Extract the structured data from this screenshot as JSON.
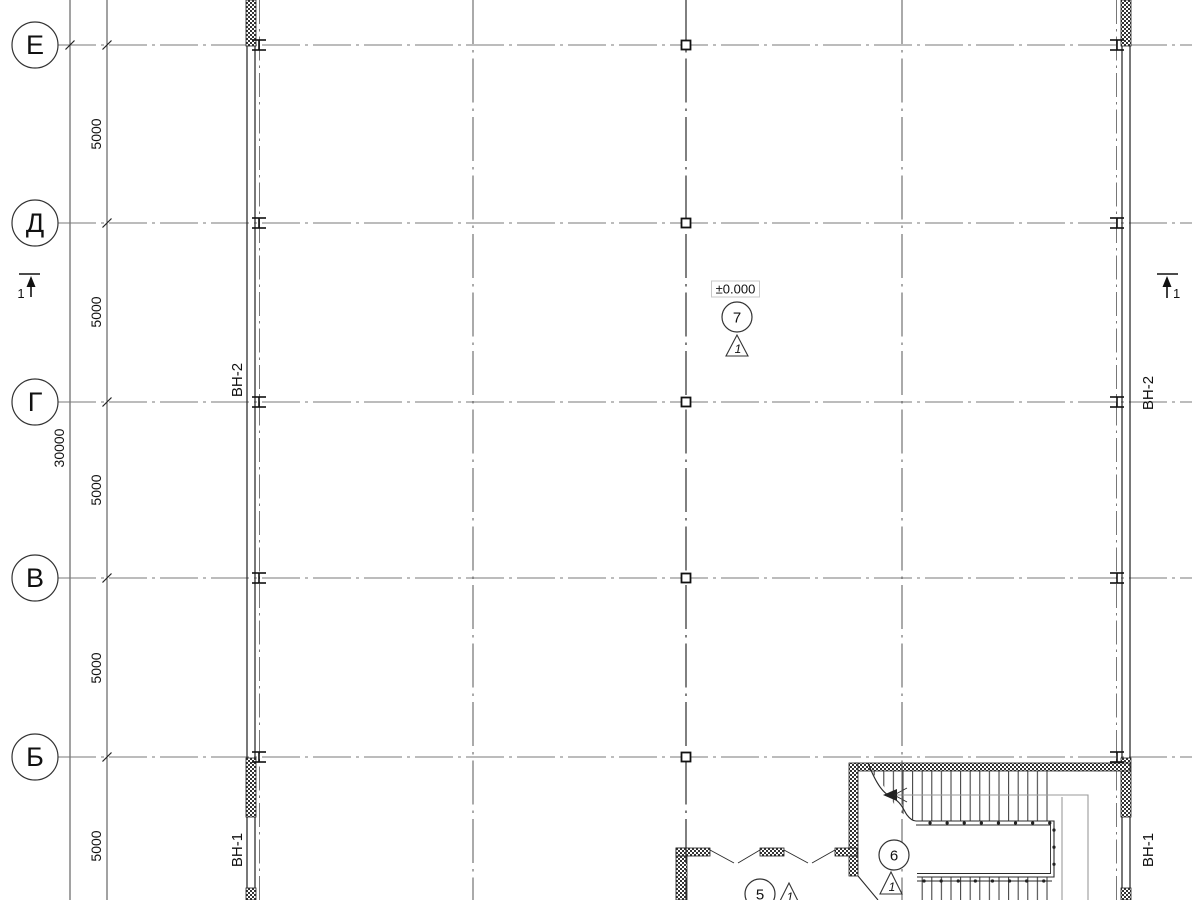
{
  "plan": {
    "row_axes": [
      {
        "label": "Е"
      },
      {
        "label": "Д"
      },
      {
        "label": "Г"
      },
      {
        "label": "В"
      },
      {
        "label": "Б"
      }
    ],
    "dimensions": {
      "segments": [
        "5000",
        "5000",
        "5000",
        "5000",
        "5000"
      ],
      "total": "30000"
    },
    "wall_tags": {
      "left_upper": "ВН-2",
      "left_lower": "ВН-1",
      "right_upper": "ВН-2",
      "right_lower": "ВН-1"
    },
    "level_mark": {
      "value": "±0.000",
      "node": "7",
      "detail": "1"
    },
    "stair_node": {
      "node": "6",
      "detail": "1"
    },
    "window_node": {
      "node": "5",
      "detail": "1"
    },
    "section_marks": {
      "left": "1",
      "right": "1"
    },
    "colors": {
      "background": "#ffffff",
      "axis_line": "#7a7a7a",
      "grid_line": "#555555",
      "center_line": "#2b2b2b",
      "wall": "#1f1f1f",
      "walk_line": "#9a9a9a",
      "level_box_border": "#c9c9c9",
      "text": "#111111"
    }
  }
}
